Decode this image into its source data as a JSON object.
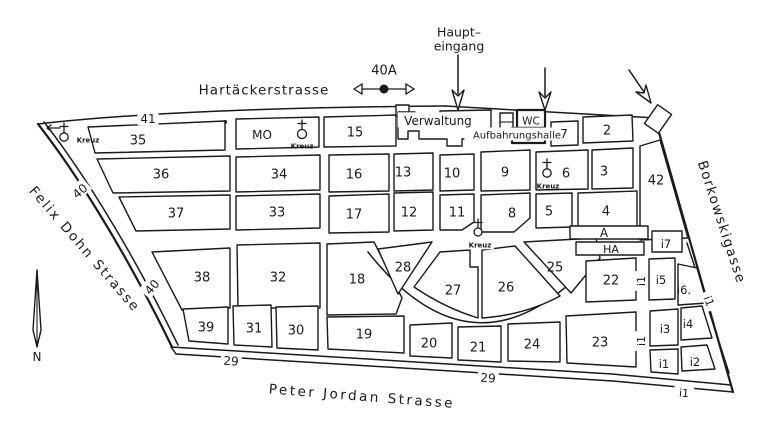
{
  "map_type": "cemetery-plan",
  "colors": {
    "ink": "#1a1a1a",
    "paper": "#ffffff"
  },
  "labels": {
    "streets": [
      {
        "id": "street-hartaeckerstrasse",
        "text": "Hartäckerstrasse",
        "x": 264,
        "y": 90,
        "size": 13.5,
        "ls": 1,
        "rotate": 0
      },
      {
        "id": "street-felix-dohn-strasse",
        "text": "Felix Dohn Strasse",
        "x": 85,
        "y": 249,
        "size": 13.5,
        "ls": 2,
        "rotate": 49
      },
      {
        "id": "street-borkowskigasse",
        "text": "Borkowskigasse",
        "x": 722,
        "y": 222,
        "size": 13.5,
        "ls": 1.5,
        "rotate": 72
      },
      {
        "id": "street-peter-jordan-strasse",
        "text": "Peter Jordan Strasse",
        "x": 362,
        "y": 396,
        "size": 13.5,
        "ls": 2.5,
        "rotate": 4.5
      }
    ],
    "entrance": [
      {
        "id": "haupteingang-line1",
        "text": "Haupt–",
        "x": 459,
        "y": 32,
        "size": 12.5
      },
      {
        "id": "haupteingang-line2",
        "text": "eingang",
        "x": 459,
        "y": 46,
        "size": 12.5
      },
      {
        "id": "marker-40a",
        "text": "40A",
        "x": 384,
        "y": 70,
        "size": 13
      }
    ],
    "buildings": [
      {
        "id": "verwaltung",
        "text": "Verwaltung",
        "x": 438,
        "y": 121,
        "size": 12,
        "bg": 1
      },
      {
        "id": "wc",
        "text": "WC",
        "x": 531,
        "y": 121,
        "size": 10.5
      },
      {
        "id": "aufbahrungshalle",
        "text": "Aufbahrungshalle",
        "x": 517,
        "y": 135,
        "size": 10,
        "bg": 1
      },
      {
        "id": "mo",
        "text": "MO",
        "x": 262,
        "y": 135,
        "size": 12
      }
    ],
    "blocks": [
      {
        "id": "block-2",
        "text": "2",
        "x": 607,
        "y": 130,
        "size": 13
      },
      {
        "id": "block-3",
        "text": "3",
        "x": 604,
        "y": 171,
        "size": 13
      },
      {
        "id": "block-4",
        "text": "4",
        "x": 606,
        "y": 211,
        "size": 13
      },
      {
        "id": "block-5",
        "text": "5",
        "x": 549,
        "y": 211,
        "size": 13
      },
      {
        "id": "block-6",
        "text": "6",
        "x": 566,
        "y": 173,
        "size": 13
      },
      {
        "id": "block-7",
        "text": "7",
        "x": 564,
        "y": 134,
        "size": 12
      },
      {
        "id": "block-8",
        "text": "8",
        "x": 512,
        "y": 213,
        "size": 13
      },
      {
        "id": "block-9",
        "text": "9",
        "x": 505,
        "y": 172,
        "size": 13
      },
      {
        "id": "block-10",
        "text": "10",
        "x": 452,
        "y": 173,
        "size": 13
      },
      {
        "id": "block-11",
        "text": "11",
        "x": 457,
        "y": 212,
        "size": 13
      },
      {
        "id": "block-12",
        "text": "12",
        "x": 409,
        "y": 212,
        "size": 13
      },
      {
        "id": "block-13",
        "text": "13",
        "x": 403,
        "y": 172,
        "size": 13
      },
      {
        "id": "block-15",
        "text": "15",
        "x": 355,
        "y": 132,
        "size": 13
      },
      {
        "id": "block-16",
        "text": "16",
        "x": 354,
        "y": 174,
        "size": 13
      },
      {
        "id": "block-17",
        "text": "17",
        "x": 354,
        "y": 214,
        "size": 13
      },
      {
        "id": "block-18",
        "text": "18",
        "x": 357,
        "y": 279,
        "size": 13
      },
      {
        "id": "block-19",
        "text": "19",
        "x": 364,
        "y": 334,
        "size": 13
      },
      {
        "id": "block-20",
        "text": "20",
        "x": 429,
        "y": 343,
        "size": 13
      },
      {
        "id": "block-21",
        "text": "21",
        "x": 478,
        "y": 347,
        "size": 13
      },
      {
        "id": "block-22",
        "text": "22",
        "x": 611,
        "y": 280,
        "size": 13
      },
      {
        "id": "block-23",
        "text": "23",
        "x": 600,
        "y": 342,
        "size": 13
      },
      {
        "id": "block-24",
        "text": "24",
        "x": 532,
        "y": 344,
        "size": 13
      },
      {
        "id": "block-25",
        "text": "25",
        "x": 555,
        "y": 267,
        "size": 13
      },
      {
        "id": "block-26",
        "text": "26",
        "x": 506,
        "y": 287,
        "size": 13
      },
      {
        "id": "block-27",
        "text": "27",
        "x": 453,
        "y": 290,
        "size": 13
      },
      {
        "id": "block-28",
        "text": "28",
        "x": 403,
        "y": 267,
        "size": 13
      },
      {
        "id": "block-30",
        "text": "30",
        "x": 296,
        "y": 330,
        "size": 13
      },
      {
        "id": "block-31",
        "text": "31",
        "x": 254,
        "y": 328,
        "size": 13
      },
      {
        "id": "block-32",
        "text": "32",
        "x": 278,
        "y": 277,
        "size": 13
      },
      {
        "id": "block-33",
        "text": "33",
        "x": 277,
        "y": 212,
        "size": 13
      },
      {
        "id": "block-34",
        "text": "34",
        "x": 279,
        "y": 174,
        "size": 13
      },
      {
        "id": "block-35",
        "text": "35",
        "x": 138,
        "y": 140,
        "size": 13
      },
      {
        "id": "block-36",
        "text": "36",
        "x": 161,
        "y": 174,
        "size": 13
      },
      {
        "id": "block-37",
        "text": "37",
        "x": 176,
        "y": 213,
        "size": 13
      },
      {
        "id": "block-38",
        "text": "38",
        "x": 202,
        "y": 277,
        "size": 13
      },
      {
        "id": "block-39",
        "text": "39",
        "x": 206,
        "y": 327,
        "size": 13
      },
      {
        "id": "block-42",
        "text": "42",
        "x": 656,
        "y": 180,
        "size": 13
      },
      {
        "id": "block-i7",
        "text": "i7",
        "x": 666,
        "y": 244,
        "size": 11.5
      },
      {
        "id": "block-i5",
        "text": "i5",
        "x": 661,
        "y": 280,
        "size": 11.5
      },
      {
        "id": "block-i6",
        "text": "i6.",
        "x": 684,
        "y": 290,
        "size": 11.5
      },
      {
        "id": "block-i3",
        "text": "i3",
        "x": 665,
        "y": 329,
        "size": 11.5
      },
      {
        "id": "block-i4",
        "text": "i4",
        "x": 688,
        "y": 324,
        "size": 11.5
      },
      {
        "id": "block-i1",
        "text": "i1",
        "x": 664,
        "y": 364,
        "size": 11.5
      },
      {
        "id": "block-i2",
        "text": "i2",
        "x": 695,
        "y": 362,
        "size": 11.5
      },
      {
        "id": "corridor-a",
        "text": "A",
        "x": 604,
        "y": 233,
        "size": 12
      },
      {
        "id": "corridor-ha",
        "text": "HA",
        "x": 611,
        "y": 249,
        "size": 11
      }
    ],
    "boundary_markers": [
      {
        "id": "path-41",
        "text": "41",
        "x": 148,
        "y": 119,
        "size": 12,
        "bg": 1
      },
      {
        "id": "path-40-upper",
        "text": "40",
        "x": 80,
        "y": 191,
        "size": 12,
        "bg": 1,
        "rotate": -40
      },
      {
        "id": "path-40-lower",
        "text": "40",
        "x": 152,
        "y": 287,
        "size": 12,
        "bg": 1,
        "rotate": -50
      },
      {
        "id": "path-29-left",
        "text": "29",
        "x": 231,
        "y": 361,
        "size": 12,
        "bg": 1,
        "rotate": 4
      },
      {
        "id": "path-29-right",
        "text": "29",
        "x": 488,
        "y": 378,
        "size": 12,
        "bg": 1,
        "rotate": 4
      },
      {
        "id": "path-i1-bottom",
        "text": "i1",
        "x": 684,
        "y": 393,
        "size": 11,
        "bg": 1,
        "rotate": 4
      },
      {
        "id": "path-i1-diagonal",
        "text": "i1",
        "x": 709,
        "y": 301,
        "size": 11,
        "bg": 1,
        "rotate": 70
      },
      {
        "id": "path-i1-vertical-upper",
        "text": "i1",
        "x": 641,
        "y": 281,
        "size": 11,
        "bg": 1,
        "rotate": -90
      },
      {
        "id": "path-i1-vertical-lower",
        "text": "i1",
        "x": 641,
        "y": 341,
        "size": 11,
        "bg": 1,
        "rotate": -90
      }
    ],
    "religious_markers": [
      {
        "id": "kreuz-west",
        "text": "Kreuz",
        "x": 88,
        "y": 140,
        "size": 7,
        "bold": 1
      },
      {
        "id": "kreuz-mo",
        "text": "Kreuz",
        "x": 302,
        "y": 146,
        "size": 7,
        "bold": 1
      },
      {
        "id": "kreuz-block6",
        "text": "Kreuz",
        "x": 548,
        "y": 186,
        "size": 7,
        "bold": 1
      },
      {
        "id": "kreuz-central",
        "text": "Kreuz",
        "x": 480,
        "y": 245,
        "size": 7,
        "bold": 1,
        "bg": 1
      }
    ],
    "compass": [
      {
        "id": "compass-n",
        "text": "N",
        "x": 37,
        "y": 357,
        "size": 12
      }
    ]
  }
}
